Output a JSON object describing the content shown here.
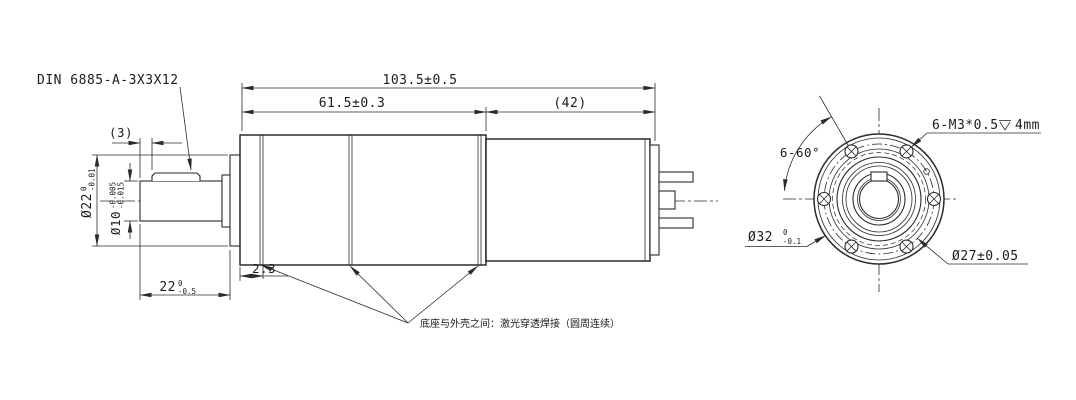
{
  "drawing": {
    "key_spec": "DIN 6885-A-3X3X12",
    "weld_note": "底座与外壳之间：激光穿透焊接（圆周连续）",
    "dims": {
      "overall_length": "103.5±0.5",
      "gearbox_length": "61.5±0.3",
      "motor_length": "(42)",
      "key_offset": "(3)",
      "shaft_length": "22",
      "shaft_length_tol_upper": "0",
      "shaft_length_tol_lower": "-0.5",
      "weld_offset": "2.3",
      "boss_diameter": "Ø22",
      "boss_tol_upper": "0",
      "boss_tol_lower": "-0.01",
      "shaft_diameter": "Ø10",
      "shaft_tol_upper": "-0.005",
      "shaft_tol_lower": "-0.015",
      "flange_diameter": "Ø32",
      "flange_tol_upper": "0",
      "flange_tol_lower": "-0.1",
      "bolt_circle_diameter": "Ø27±0.05",
      "hole_pattern_angle": "6-60°",
      "thread_spec_prefix": "6-M3*0.5",
      "thread_depth_symbol": "⊽",
      "thread_spec_suffix": "4mm"
    }
  }
}
